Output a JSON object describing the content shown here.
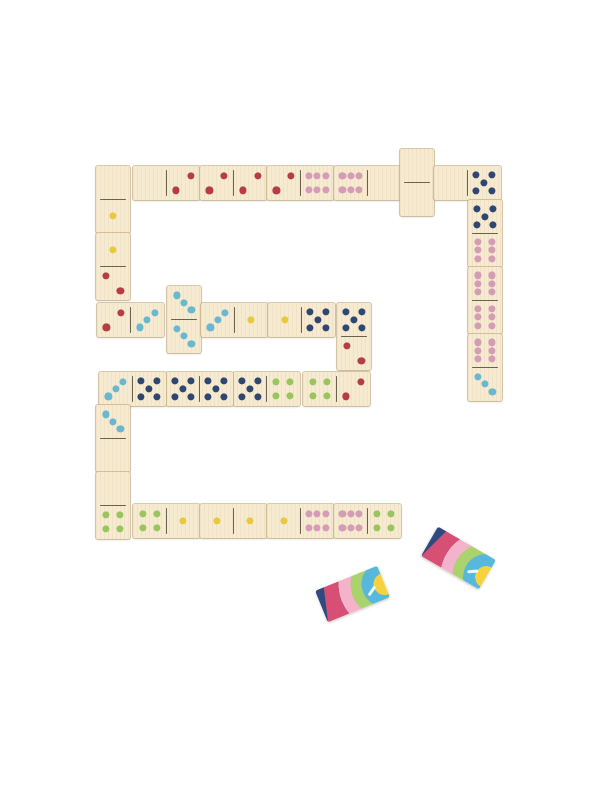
{
  "scene": {
    "background_color": "#ffffff",
    "wood_color": "#f6ead0",
    "wood_seam_color": "#baa06e",
    "divider_line_color": "#4f4a38",
    "placed_tile_count": 26,
    "face_down_tile_count": 2
  },
  "pip_colors": {
    "1": "#e8c93e",
    "2": "#b63c45",
    "3": "#6ab8cf",
    "4": "#9ac45e",
    "5": "#2f4670",
    "6": "#d59cb6"
  },
  "pip_value_legend": {
    "0": "blank",
    "1": "yellow",
    "2": "red",
    "3": "light-blue",
    "4": "green",
    "5": "dark-blue",
    "6": "pink"
  },
  "dominoes": [
    {
      "x": 96,
      "y": 166,
      "o": "v",
      "values": [
        0,
        1
      ]
    },
    {
      "x": 133,
      "y": 166,
      "o": "h",
      "values": [
        0,
        2
      ]
    },
    {
      "x": 200,
      "y": 166,
      "o": "h",
      "values": [
        2,
        2
      ]
    },
    {
      "x": 267,
      "y": 166,
      "o": "h",
      "values": [
        2,
        6
      ]
    },
    {
      "x": 334,
      "y": 166,
      "o": "h",
      "values": [
        6,
        0
      ]
    },
    {
      "x": 400,
      "y": 149,
      "o": "v",
      "values": [
        0,
        0
      ]
    },
    {
      "x": 434,
      "y": 166,
      "o": "h",
      "values": [
        0,
        5
      ]
    },
    {
      "x": 468,
      "y": 200,
      "o": "v",
      "values": [
        5,
        6
      ]
    },
    {
      "x": 468,
      "y": 267,
      "o": "v",
      "values": [
        6,
        6
      ]
    },
    {
      "x": 468,
      "y": 334,
      "o": "v",
      "values": [
        6,
        3
      ]
    },
    {
      "x": 96,
      "y": 233,
      "o": "v",
      "values": [
        1,
        2
      ]
    },
    {
      "x": 97,
      "y": 303,
      "o": "h",
      "values": [
        2,
        3
      ]
    },
    {
      "x": 167,
      "y": 286,
      "o": "v",
      "values": [
        3,
        3
      ]
    },
    {
      "x": 201,
      "y": 303,
      "o": "h",
      "values": [
        3,
        1
      ]
    },
    {
      "x": 268,
      "y": 303,
      "o": "h",
      "values": [
        1,
        5
      ]
    },
    {
      "x": 337,
      "y": 303,
      "o": "v",
      "values": [
        5,
        2
      ]
    },
    {
      "x": 303,
      "y": 372,
      "o": "h",
      "values": [
        4,
        2
      ]
    },
    {
      "x": 233,
      "y": 372,
      "o": "h",
      "values": [
        5,
        4
      ]
    },
    {
      "x": 166,
      "y": 372,
      "o": "h",
      "values": [
        5,
        5
      ]
    },
    {
      "x": 99,
      "y": 372,
      "o": "h",
      "values": [
        3,
        5
      ]
    },
    {
      "x": 96,
      "y": 405,
      "o": "v",
      "values": [
        3,
        0
      ]
    },
    {
      "x": 96,
      "y": 472,
      "o": "v",
      "values": [
        0,
        4
      ]
    },
    {
      "x": 133,
      "y": 504,
      "o": "h",
      "values": [
        4,
        1
      ]
    },
    {
      "x": 200,
      "y": 504,
      "o": "h",
      "values": [
        1,
        1
      ]
    },
    {
      "x": 267,
      "y": 504,
      "o": "h",
      "values": [
        1,
        6
      ]
    },
    {
      "x": 334,
      "y": 504,
      "o": "h",
      "values": [
        6,
        4
      ]
    }
  ],
  "rainbow_tiles": [
    {
      "x": 318.5,
      "y": 577,
      "rotation_deg": -22
    },
    {
      "x": 424.5,
      "y": 541,
      "rotation_deg": 30
    }
  ],
  "rainbow_back_colors": {
    "navy": "#2e4a80",
    "crimson": "#d64f75",
    "light_pink": "#f3b3ca",
    "green": "#abd36d",
    "sky_blue": "#57b8dc",
    "yellow": "#f6d23f"
  }
}
